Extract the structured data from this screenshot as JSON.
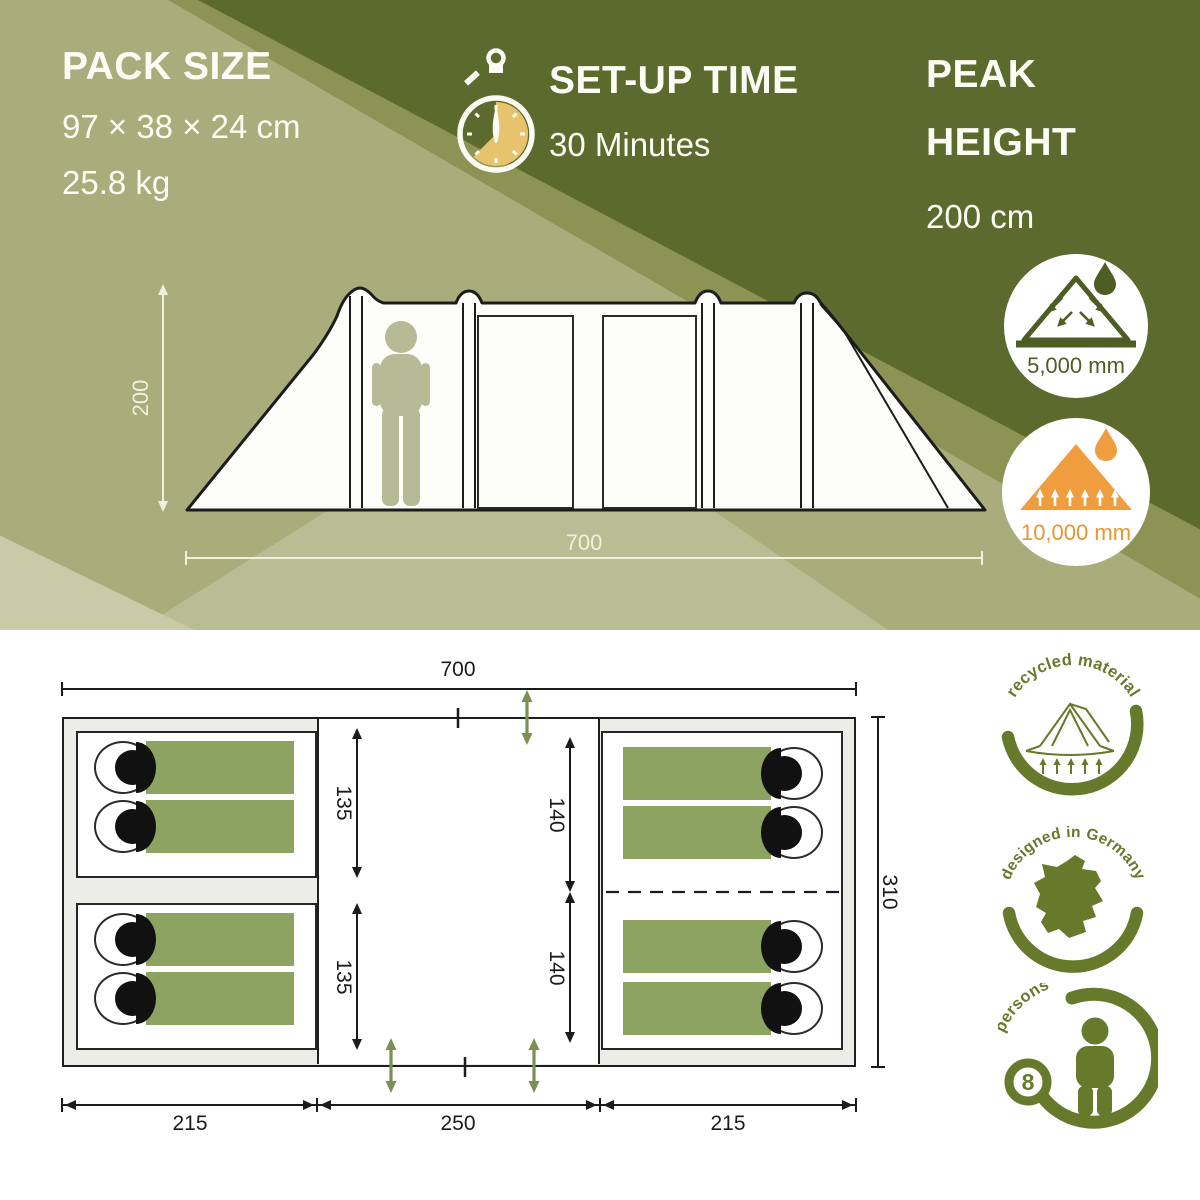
{
  "specs": {
    "pack": {
      "title": "PACK SIZE",
      "dims": "97 × 38 × 24 cm",
      "weight": "25.8 kg"
    },
    "setup": {
      "title": "SET-UP TIME",
      "value": "30 Minutes"
    },
    "peak": {
      "line1": "PEAK",
      "line2": "HEIGHT",
      "value": "200 cm"
    }
  },
  "side_view": {
    "height": "200",
    "width": "700"
  },
  "ratings": {
    "rain": "5,000 mm",
    "ground": "10,000 mm"
  },
  "floorplan": {
    "width": "700",
    "depth": "310",
    "bottom": [
      "215",
      "250",
      "215"
    ],
    "left_cabins": [
      "135",
      "135"
    ],
    "mid_segments": [
      "140",
      "140"
    ]
  },
  "badges": {
    "recycled": "recycled material",
    "designed": "designed in Germany",
    "persons_count": "8",
    "persons_label": "persons"
  },
  "colors": {
    "dark_olive": "#5c6a2e",
    "mid_olive": "#8c9355",
    "light_sage": "#a9ad7b",
    "beam": "#b9bd93",
    "pale_corner": "#c9cba8",
    "badge_olive": "#67792a",
    "rating_green": "#4d5d24",
    "orange": "#ef9d3e",
    "bag_green": "#8da361",
    "stopwatch_tan": "#e7c36d"
  }
}
